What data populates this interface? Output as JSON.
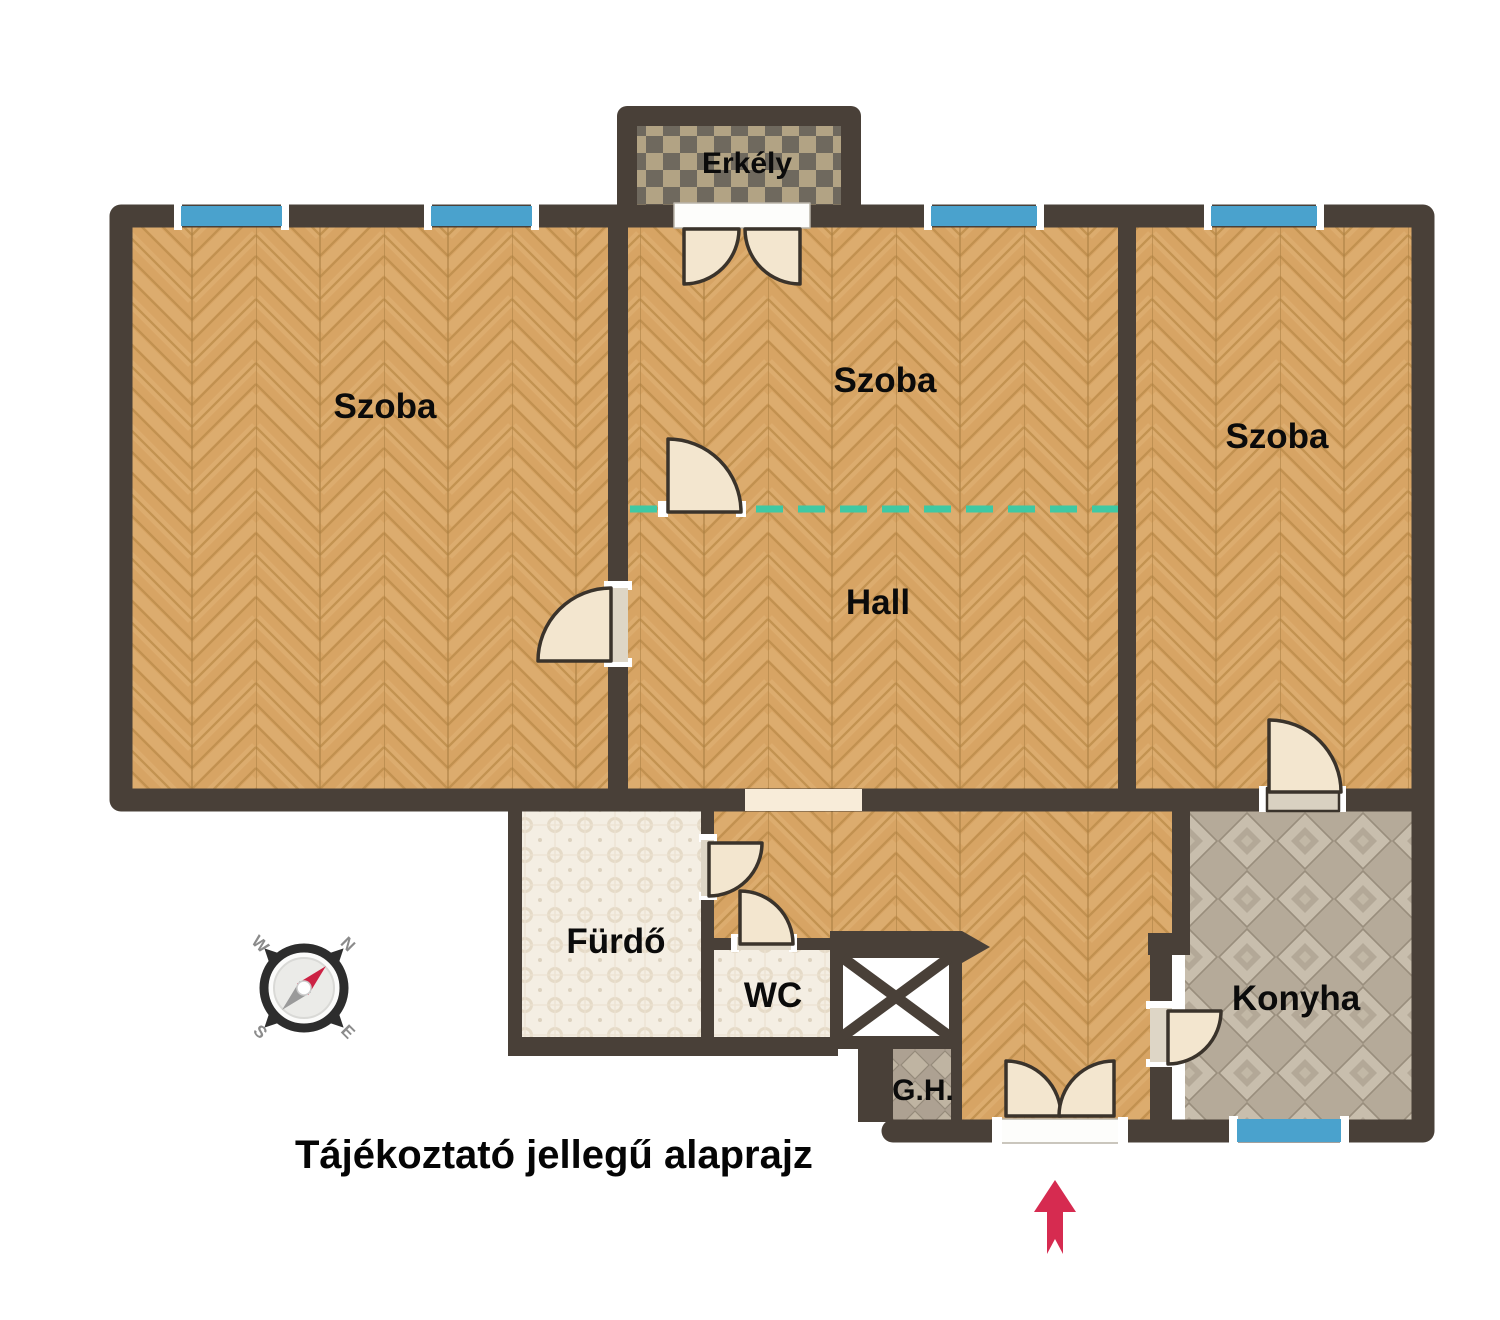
{
  "caption": "Tájékoztató jellegű alaprajz",
  "rooms": {
    "balcony": "Erkély",
    "szoba_left": "Szoba",
    "szoba_middle": "Szoba",
    "szoba_right": "Szoba",
    "hall": "Hall",
    "bathroom": "Fürdő",
    "wc": "WC",
    "kitchen": "Konyha",
    "utility": "G.H."
  },
  "compass": {
    "north": "N",
    "east": "E",
    "south": "S",
    "west": "W"
  },
  "colors": {
    "wall": "#494038",
    "wood_base": "#d7a464",
    "window_blue": "#4aa2cd",
    "divider_teal": "#3ec9a4",
    "door_leaf": "#f3e6cf",
    "door_outline": "#3a332b",
    "entrance_arrow": "#d62b50",
    "balcony_tile_light": "#b2a384",
    "balcony_tile_dark": "#6f695e",
    "kitchen_tile": "#b5aa99",
    "bath_tile": "#f4eee3",
    "utility_tile": "#ada192",
    "compass_needle_red": "#cc2244",
    "compass_needle_gray": "#9a9a9a"
  }
}
